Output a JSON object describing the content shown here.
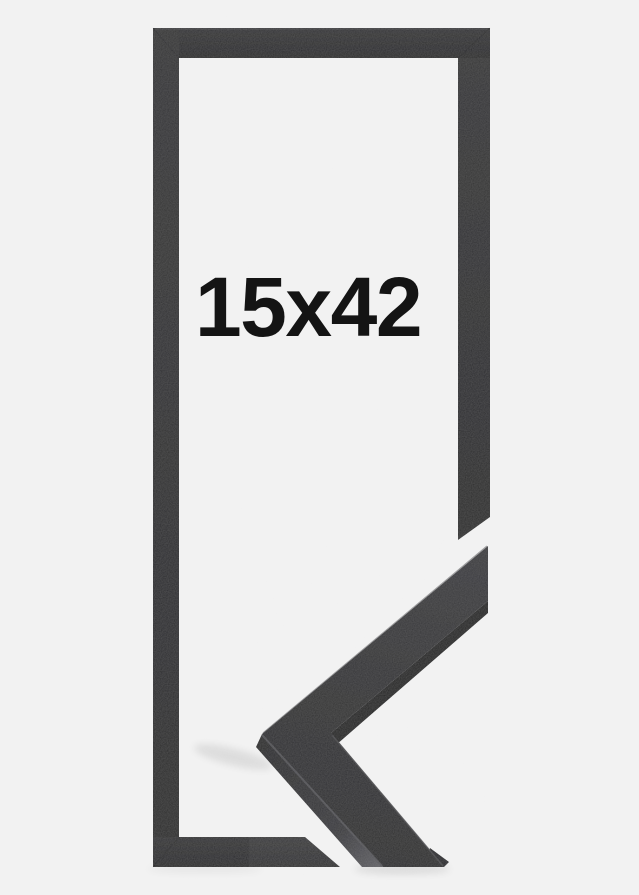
{
  "product": {
    "size_label": "15x42"
  },
  "colors": {
    "background": "#f2f2f2",
    "frame": "#2e2e30",
    "label": "#141414"
  }
}
